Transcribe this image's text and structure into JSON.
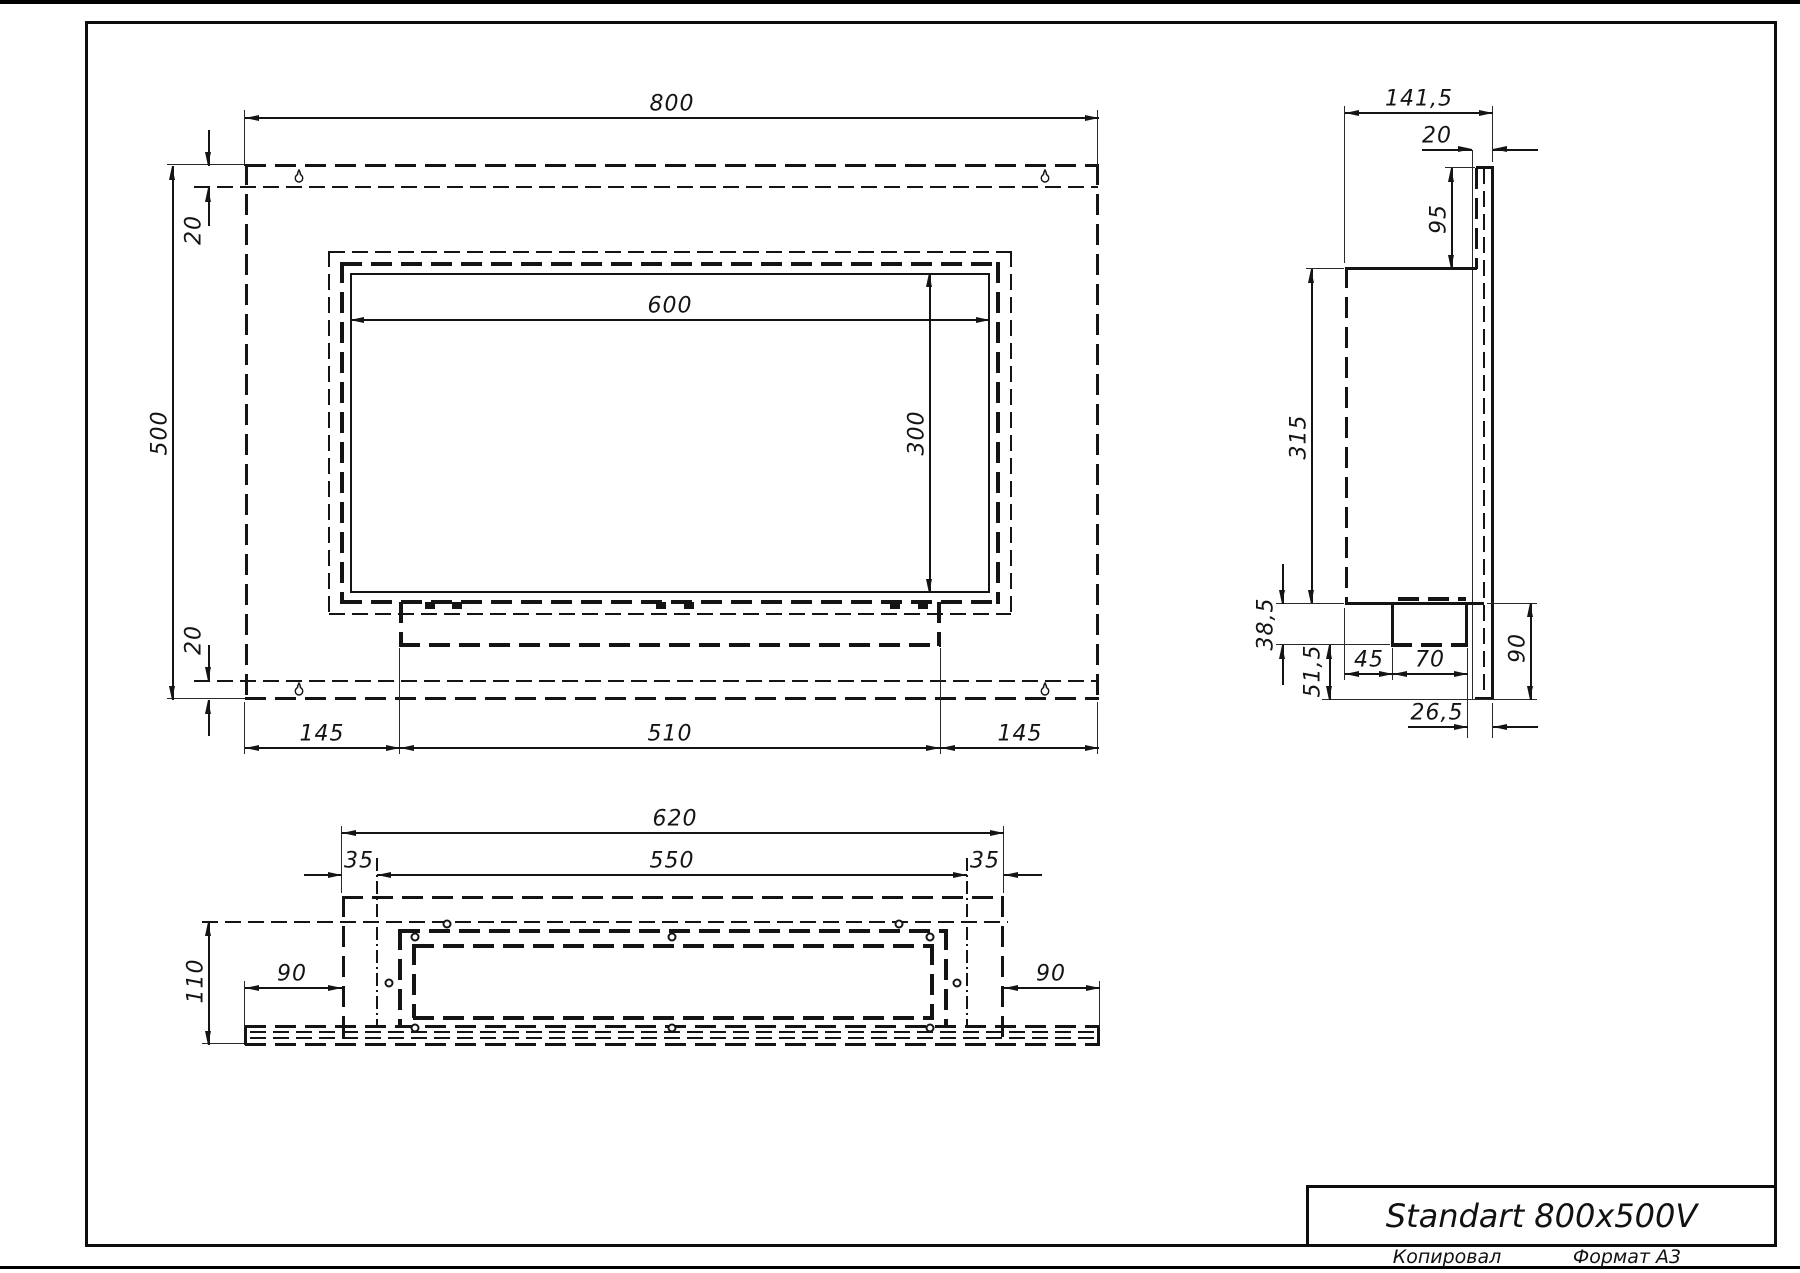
{
  "document": {
    "type": "technical-drawing",
    "product": "Standart 800x500V"
  },
  "title_block": {
    "title": "Standart 800x500V",
    "copied_label": "Копировал",
    "format_label": "Формат А3"
  },
  "front_view": {
    "dims": {
      "overall_width": "800",
      "overall_height": "500",
      "top_inset": "20",
      "bottom_inset": "20",
      "opening_width": "600",
      "opening_height": "300",
      "bottom_left_segment": "145",
      "bottom_center_segment": "510",
      "bottom_right_segment": "145"
    }
  },
  "side_view": {
    "dims": {
      "overall_depth": "141,5",
      "bracket_gap": "20",
      "panel_above_body": "95",
      "body_height": "315",
      "burner_drop": "38,5",
      "lower_gap": "51,5",
      "front_offset": "45",
      "burner_depth": "70",
      "panel_below_body": "90",
      "back_offset": "26,5"
    }
  },
  "bottom_view": {
    "dims": {
      "box_width": "620",
      "opening_width": "550",
      "margin_left": "35",
      "margin_right": "35",
      "box_depth": "110",
      "wing_left": "90",
      "wing_right": "90"
    }
  }
}
